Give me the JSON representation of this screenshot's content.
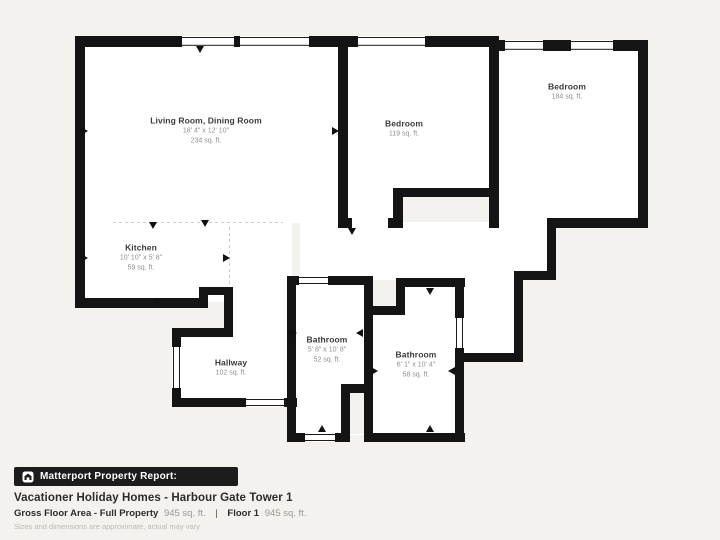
{
  "report_bar": {
    "label": "Matterport Property Report:",
    "icon": "matterport-house-icon",
    "bg_color": "#1c1c1c",
    "text_color": "#ffffff"
  },
  "property": {
    "title": "Vacationer Holiday Homes - Harbour Gate Tower 1",
    "gross_label": "Gross Floor Area - Full Property",
    "gross_value": "945 sq. ft.",
    "separator": "|",
    "floor_label": "Floor 1",
    "floor_value": "945 sq. ft.",
    "disclaimer": "Sizes and dimensions are approximate, actual may vary"
  },
  "floor_plan": {
    "colors": {
      "background": "#f4f2ef",
      "wall": "#141414",
      "room_fill": "#ffffff",
      "room_name": "#3a3a3a",
      "room_sub": "#8f8f8f"
    },
    "rooms": [
      {
        "id": "living-dining",
        "name": "Living Room, Dining Room",
        "dimensions": "18' 4\" x 12' 10\"",
        "area": "234 sq. ft.",
        "x": 206,
        "y": 131
      },
      {
        "id": "kitchen",
        "name": "Kitchen",
        "dimensions": "10' 10\" x 5' 8\"",
        "area": "59 sq. ft.",
        "x": 141,
        "y": 258
      },
      {
        "id": "bedroom-middle",
        "name": "Bedroom",
        "dimensions": "",
        "area": "119 sq. ft.",
        "x": 404,
        "y": 129
      },
      {
        "id": "bedroom-right",
        "name": "Bedroom",
        "dimensions": "",
        "area": "184 sq. ft.",
        "x": 567,
        "y": 92
      },
      {
        "id": "hallway",
        "name": "Hallway",
        "dimensions": "",
        "area": "102 sq. ft.",
        "x": 231,
        "y": 368
      },
      {
        "id": "bathroom-left",
        "name": "Bathroom",
        "dimensions": "5' 8\" x 10' 8\"",
        "area": "52 sq. ft.",
        "x": 327,
        "y": 350
      },
      {
        "id": "bathroom-right",
        "name": "Bathroom",
        "dimensions": "6' 1\" x 10' 4\"",
        "area": "58 sq. ft.",
        "x": 416,
        "y": 365
      }
    ]
  }
}
